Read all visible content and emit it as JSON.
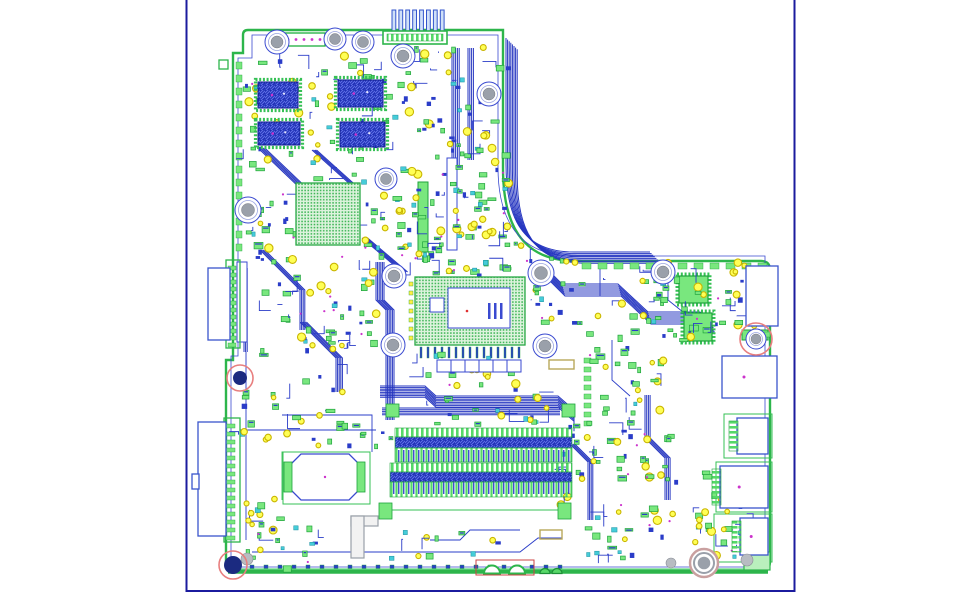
{
  "canvas": {
    "width": 977,
    "height": 602,
    "background": "#ffffff"
  },
  "palette": {
    "sheet_border": "#1b1b9e",
    "board_edge_green": "#2db54b",
    "board_edge_dark": "#1e8f38",
    "keepout_blue": "#3a4ad0",
    "trace_blue": "#2a3cc8",
    "chip_blue": "#1d2eb4",
    "chip_blue_light": "#5e6fe6",
    "part_green": "#79e77e",
    "part_green_dark": "#1fa33c",
    "pad_field_green": "#35b24f",
    "pad_field_bg": "#ddf3dd",
    "test_point_yellow": "#ffff55",
    "test_point_ring": "#c9b500",
    "cyan": "#45ccd8",
    "magenta": "#cc33cc",
    "hole_gray": "#9aa0aa",
    "khaki": "#b8a85a",
    "red_marker": "#e87f7f",
    "navy_fill": "#1b2a80",
    "port_blue": "#3a55cc"
  },
  "pcb": {
    "sheet": {
      "border_path": "M186.5,0 V591 H794.5 V0"
    },
    "outline": "M248,30 H503 V168 C503,222 520,261 576,261 H761 Q770,261 770,270 V561 Q770,572 759,572 H237 Q226,572 226,561 V360 H233 V53 H243 V35 Q243,30 248,30 Z",
    "keepout": "M252,35 H498 V167 C498,218 517,256 574,256 H765 V567 H231 V356 H238 V58 H252 Z",
    "bottom_edge": {
      "x1": 228,
      "x2": 768,
      "y": 571.5
    },
    "notches": {
      "white": [
        [
          492,
          8
        ],
        [
          517,
          8
        ]
      ],
      "green": [
        [
          545,
          5
        ],
        [
          557,
          5
        ]
      ],
      "red_rect": [
        476,
        560,
        58,
        15
      ]
    },
    "bundles": [
      {
        "d": "M506,38 V164 C506,218 522,252 574,252 H650",
        "n": 8,
        "dx": 1.6,
        "dy": 1.6
      },
      {
        "d": "M540,262 L562,284 L618,284 L648,312 L700,312 L712,322",
        "n": 7,
        "dx": 0.5,
        "dy": 2
      },
      {
        "d": "M376,262 V300 L386,310 V420",
        "n": 6,
        "dx": 1.6,
        "dy": 0
      },
      {
        "d": "M380,386 L425,386 L436,396 L558,396 L574,410 L574,420",
        "n": 8,
        "dx": 0,
        "dy": 1.6
      },
      {
        "d": "M382,408 H560",
        "n": 5,
        "dx": 0,
        "dy": 1.7
      },
      {
        "d": "M258,148 L302,190 L302,230",
        "n": 5,
        "dx": 1.7,
        "dy": 0
      },
      {
        "d": "M312,150 L352,186",
        "n": 4,
        "dx": 1.5,
        "dy": 0
      },
      {
        "d": "M362,238 L402,272",
        "n": 5,
        "dx": 1.4,
        "dy": 0
      },
      {
        "d": "M300,322 L336,358 V392",
        "n": 5,
        "dx": 1.6,
        "dy": 0
      },
      {
        "d": "M452,48 V168",
        "n": 5,
        "dx": 1.8,
        "dy": 0
      },
      {
        "d": "M468,48 V160",
        "n": 4,
        "dx": 1.8,
        "dy": 0
      },
      {
        "d": "M645,395 V438 L665,458 V500",
        "n": 4,
        "dx": 1.7,
        "dy": 0
      },
      {
        "d": "M570,444 L588,462 V520",
        "n": 4,
        "dx": 1.6,
        "dy": 0
      },
      {
        "d": "M244,268 V352",
        "n": 3,
        "dx": 1.6,
        "dy": 0
      },
      {
        "d": "M260,250 L300,290 V330",
        "n": 4,
        "dx": 1.6,
        "dy": 0
      }
    ],
    "traces": [
      {
        "d": "M240,430 H376",
        "c": "#2a3cc8"
      },
      {
        "d": "M246,352 V540",
        "c": "#2a3cc8"
      },
      {
        "d": "M252,552 H520 L538,538 H562",
        "c": "#2a3cc8"
      },
      {
        "d": "M600,268 V296",
        "c": "#2a3cc8"
      },
      {
        "d": "M668,262 V300 L688,316",
        "c": "#2a3cc8"
      },
      {
        "d": "M282,415 H372 V452",
        "c": "#2a3cc8"
      },
      {
        "d": "M392,510 H558",
        "c": "#35c054"
      },
      {
        "d": "M300,452 H282 V500",
        "c": "#35c054"
      },
      {
        "d": "M430,540 L460,540 L470,530 H520",
        "c": "#2a3cc8"
      },
      {
        "d": "M612,340 V380 L630,396",
        "c": "#2a3cc8"
      }
    ],
    "pad_rows": [
      {
        "x": 236,
        "y": 62,
        "dx": 0,
        "dy": 13,
        "n": 15,
        "w": 6,
        "h": 7,
        "fill": "#79e77e"
      },
      {
        "x": 582,
        "y": 263,
        "dx": 16,
        "dy": 0,
        "n": 12,
        "w": 9,
        "h": 6,
        "fill": "#79e77e"
      },
      {
        "x": 250,
        "y": 565,
        "dx": 14,
        "dy": 0,
        "n": 23,
        "w": 4,
        "h": 3.5,
        "fill": "#2a3cc8"
      },
      {
        "x": 228,
        "y": 266,
        "dx": 0,
        "dy": 7,
        "n": 12,
        "w": 8,
        "h": 4,
        "fill": "#79e77e"
      },
      {
        "x": 226,
        "y": 424,
        "dx": 0,
        "dy": 8,
        "n": 15,
        "w": 9,
        "h": 4,
        "fill": "#79e77e"
      },
      {
        "x": 420,
        "y": 347,
        "dx": 7,
        "dy": 0,
        "n": 15,
        "w": 2,
        "h": 11,
        "fill": "#2a3cc8"
      },
      {
        "x": 409,
        "y": 282,
        "dx": 0,
        "dy": 9,
        "n": 7,
        "w": 4,
        "h": 4,
        "fill": "#ffee44"
      },
      {
        "x": 584,
        "y": 358,
        "dx": 0,
        "dy": 9,
        "n": 8,
        "w": 7,
        "h": 5,
        "fill": "#79e77e"
      },
      {
        "x": 748,
        "y": 332,
        "dx": 8,
        "dy": 0,
        "n": 3,
        "w": 6,
        "h": 5,
        "fill": "#79e77e"
      }
    ],
    "misc_rects": [
      {
        "x": 679,
        "y": 276,
        "w": 29,
        "h": 27,
        "fill": "#79e77e",
        "stroke": "#1fa33c",
        "sw": 1.2,
        "dash": true
      },
      {
        "x": 684,
        "y": 313,
        "w": 28,
        "h": 28,
        "fill": "#79e77e",
        "stroke": "#1fa33c",
        "sw": 1.2,
        "dash": true
      },
      {
        "x": 549,
        "y": 360,
        "w": 25,
        "h": 9,
        "fill": "none",
        "stroke": "#b8a85a",
        "sw": 1.4
      },
      {
        "x": 540,
        "y": 530,
        "w": 22,
        "h": 9,
        "fill": "none",
        "stroke": "#b8a85a",
        "sw": 1.4
      },
      {
        "x": 237,
        "y": 262,
        "w": 10,
        "h": 80,
        "fill": "#ffffff",
        "stroke": "#3a4ad0",
        "sw": 1
      },
      {
        "x": 283,
        "y": 33,
        "w": 42,
        "h": 13,
        "fill": "#ffffff",
        "stroke": "#2db54b",
        "sw": 1.4,
        "dots": "#cc33cc"
      },
      {
        "x": 219,
        "y": 60,
        "w": 9,
        "h": 9,
        "fill": "#ffffff",
        "stroke": "#2db54b",
        "sw": 1.3
      },
      {
        "x": 742,
        "y": 330,
        "w": 26,
        "h": 10,
        "fill": "#79e77e",
        "stroke": "#1fa33c",
        "sw": 1
      },
      {
        "x": 716,
        "y": 462,
        "w": 56,
        "h": 50,
        "fill": "none",
        "stroke": "#35c054",
        "sw": 1
      },
      {
        "x": 714,
        "y": 514,
        "w": 58,
        "h": 48,
        "fill": "none",
        "stroke": "#35c054",
        "sw": 1
      },
      {
        "x": 724,
        "y": 414,
        "w": 48,
        "h": 44,
        "fill": "none",
        "stroke": "#35c054",
        "sw": 1
      },
      {
        "x": 744,
        "y": 552,
        "w": 26,
        "h": 18,
        "fill": "#b9f0bd",
        "stroke": "#2db54b",
        "sw": 1.2
      },
      {
        "x": 351,
        "y": 516,
        "w": 27,
        "h": 10,
        "fill": "#f2f2f2",
        "stroke": "#99a0a8",
        "sw": 1.2
      },
      {
        "x": 351,
        "y": 516,
        "w": 13,
        "h": 42,
        "fill": "#f2f2f2",
        "stroke": "#99a0a8",
        "sw": 1.2
      },
      {
        "x": 226,
        "y": 260,
        "w": 14,
        "h": 88,
        "fill": "none",
        "stroke": "#2db54b",
        "sw": 1.3
      },
      {
        "x": 224,
        "y": 418,
        "w": 16,
        "h": 124,
        "fill": "none",
        "stroke": "#2db54b",
        "sw": 1.3
      },
      {
        "x": 418,
        "y": 182,
        "w": 10,
        "h": 70,
        "fill": "#79e77e",
        "stroke": "#1fa33c",
        "sw": 1
      },
      {
        "x": 447,
        "y": 158,
        "w": 10,
        "h": 92,
        "fill": "#ffffff",
        "stroke": "#3a4ad0",
        "sw": 1
      }
    ],
    "bgas": [
      {
        "name": "cpu-bga",
        "x": 415,
        "y": 277,
        "w": 110,
        "h": 68
      },
      {
        "name": "pch-bga",
        "x": 296,
        "y": 183,
        "w": 64,
        "h": 62
      }
    ],
    "cpu_detail": {
      "inner": [
        448,
        288,
        62,
        40
      ],
      "aux_rect": [
        430,
        298,
        14,
        14
      ],
      "bars": [
        [
          488,
          303
        ],
        [
          494,
          303
        ],
        [
          500,
          303
        ]
      ],
      "bar_size": [
        2.5,
        16
      ],
      "red_dot": [
        467,
        311
      ]
    },
    "ram_chips": [
      {
        "x": 258,
        "y": 82,
        "w": 40,
        "h": 26
      },
      {
        "x": 338,
        "y": 80,
        "w": 45,
        "h": 27
      },
      {
        "x": 258,
        "y": 122,
        "w": 42,
        "h": 23
      },
      {
        "x": 340,
        "y": 122,
        "w": 45,
        "h": 25
      }
    ],
    "top_connector": {
      "fingers": {
        "x0": 392,
        "dx": 6.9,
        "n": 8,
        "y": 10,
        "w": 3.8,
        "h": 22
      },
      "base": [
        383,
        31,
        64,
        13
      ],
      "pads_row": [
        387,
        34,
        56,
        7
      ]
    },
    "dimm": {
      "slots": [
        {
          "comb1": [
            395,
            428,
            177,
            9
          ],
          "bar": [
            395,
            437,
            177,
            11
          ],
          "comb2": [
            395,
            448,
            177,
            14
          ]
        },
        {
          "comb1": [
            390,
            463,
            182,
            9
          ],
          "bar": [
            390,
            472,
            182,
            10
          ],
          "comb2": [
            390,
            482,
            182,
            15
          ]
        }
      ],
      "latches": [
        [
          379,
          503,
          13,
          16
        ],
        [
          558,
          503,
          13,
          16
        ],
        [
          386,
          404,
          13,
          13
        ],
        [
          562,
          404,
          13,
          13
        ]
      ]
    },
    "battery": {
      "cx": 325,
      "cy": 477,
      "w": 74,
      "h": 46,
      "cut": 13,
      "frame": [
        283,
        452,
        87,
        52
      ],
      "tabs": [
        [
          284,
          462,
          8,
          30
        ],
        [
          357,
          462,
          8,
          30
        ]
      ]
    },
    "linked_cells": {
      "x": 437,
      "y": 360,
      "n": 6,
      "cw": 14,
      "ch": 12
    },
    "ports_right": [
      {
        "x": 746,
        "y": 266,
        "w": 32,
        "h": 60,
        "comb": false,
        "dot": false
      },
      {
        "x": 722,
        "y": 356,
        "w": 55,
        "h": 42,
        "comb": false,
        "dot": true
      },
      {
        "x": 737,
        "y": 418,
        "w": 31,
        "h": 36,
        "comb": true,
        "dot": false
      },
      {
        "x": 720,
        "y": 466,
        "w": 48,
        "h": 42,
        "comb": true,
        "dot": true
      },
      {
        "x": 740,
        "y": 518,
        "w": 28,
        "h": 37,
        "comb": true,
        "dot": true
      }
    ],
    "ports_left": [
      {
        "x": 208,
        "y": 268,
        "w": 22,
        "h": 72
      },
      {
        "x": 198,
        "y": 422,
        "w": 28,
        "h": 114
      },
      {
        "x": 192,
        "y": 474,
        "w": 7,
        "h": 15
      }
    ],
    "holes": [
      [
        277,
        42,
        12
      ],
      [
        335,
        39,
        11
      ],
      [
        363,
        42,
        11
      ],
      [
        403,
        56,
        12
      ],
      [
        489,
        94,
        12
      ],
      [
        248,
        210,
        13
      ],
      [
        386,
        179,
        11
      ],
      [
        394,
        276,
        12
      ],
      [
        393,
        345,
        12
      ],
      [
        541,
        273,
        13
      ],
      [
        545,
        346,
        12
      ],
      [
        663,
        272,
        12
      ],
      [
        756,
        339,
        10
      ]
    ],
    "target_hole": [
      704,
      563,
      14
    ],
    "gray_dots": [
      [
        247,
        559,
        6
      ],
      [
        671,
        563,
        5
      ],
      [
        747,
        560,
        6
      ]
    ],
    "red_marks": [
      {
        "x": 240,
        "y": 378,
        "rc": 13,
        "center": 7
      },
      {
        "x": 233,
        "y": 565,
        "rc": 14,
        "center": 9
      },
      {
        "x": 756,
        "y": 339,
        "rc": 16,
        "center": 0
      }
    ],
    "clusters": [
      {
        "x": 246,
        "y": 52,
        "w": 142,
        "h": 128,
        "n": 62,
        "seed": 1
      },
      {
        "x": 392,
        "y": 44,
        "w": 114,
        "h": 132,
        "n": 72,
        "seed": 2
      },
      {
        "x": 246,
        "y": 188,
        "w": 50,
        "h": 72,
        "n": 24,
        "seed": 3
      },
      {
        "x": 362,
        "y": 183,
        "w": 76,
        "h": 82,
        "n": 40,
        "seed": 4
      },
      {
        "x": 440,
        "y": 178,
        "w": 72,
        "h": 62,
        "n": 42,
        "seed": 5
      },
      {
        "x": 415,
        "y": 240,
        "w": 108,
        "h": 34,
        "n": 30,
        "seed": 6
      },
      {
        "x": 252,
        "y": 256,
        "w": 126,
        "h": 104,
        "n": 46,
        "seed": 7
      },
      {
        "x": 526,
        "y": 254,
        "w": 136,
        "h": 86,
        "n": 40,
        "seed": 8
      },
      {
        "x": 640,
        "y": 262,
        "w": 128,
        "h": 78,
        "n": 55,
        "seed": 9
      },
      {
        "x": 580,
        "y": 344,
        "w": 92,
        "h": 78,
        "n": 30,
        "seed": 10
      },
      {
        "x": 586,
        "y": 424,
        "w": 84,
        "h": 54,
        "n": 30,
        "seed": 11
      },
      {
        "x": 300,
        "y": 406,
        "w": 92,
        "h": 42,
        "n": 18,
        "seed": 12
      },
      {
        "x": 238,
        "y": 388,
        "w": 62,
        "h": 56,
        "n": 15,
        "seed": 13
      },
      {
        "x": 402,
        "y": 350,
        "w": 138,
        "h": 52,
        "n": 28,
        "seed": 14
      },
      {
        "x": 545,
        "y": 412,
        "w": 38,
        "h": 96,
        "n": 14,
        "seed": 15
      },
      {
        "x": 640,
        "y": 465,
        "w": 115,
        "h": 68,
        "n": 34,
        "seed": 16
      },
      {
        "x": 246,
        "y": 520,
        "w": 84,
        "h": 46,
        "n": 16,
        "seed": 17
      },
      {
        "x": 585,
        "y": 505,
        "w": 80,
        "h": 55,
        "n": 22,
        "seed": 18
      },
      {
        "x": 243,
        "y": 60,
        "w": 16,
        "h": 190,
        "n": 16,
        "seed": 19
      },
      {
        "x": 246,
        "y": 495,
        "w": 42,
        "h": 40,
        "n": 13,
        "seed": 20
      },
      {
        "x": 688,
        "y": 522,
        "w": 55,
        "h": 40,
        "n": 12,
        "seed": 21
      },
      {
        "x": 300,
        "y": 300,
        "w": 66,
        "h": 92,
        "n": 20,
        "seed": 22
      },
      {
        "x": 370,
        "y": 528,
        "w": 130,
        "h": 34,
        "n": 12,
        "seed": 23
      },
      {
        "x": 430,
        "y": 405,
        "w": 120,
        "h": 22,
        "n": 16,
        "seed": 24
      }
    ]
  }
}
